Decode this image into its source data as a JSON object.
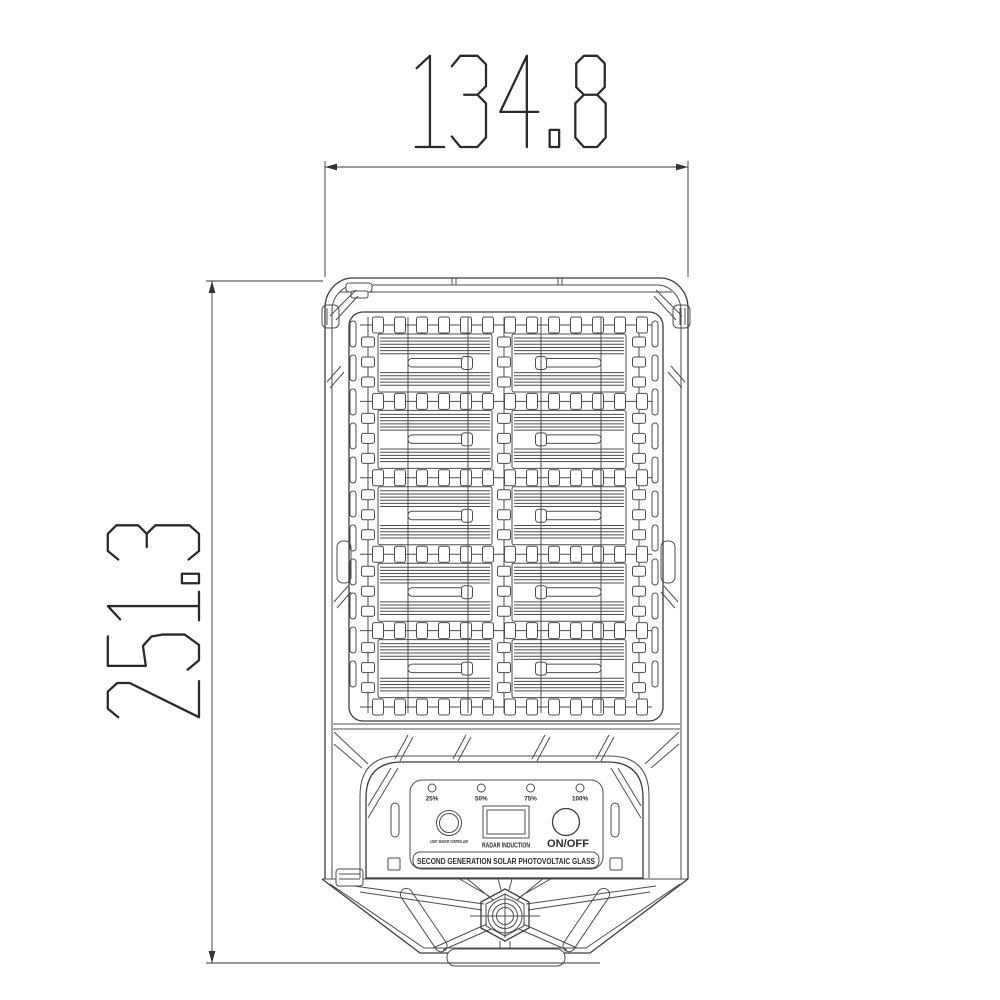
{
  "drawing": {
    "width_dim": "134.8",
    "height_dim": "251.3"
  },
  "control_panel": {
    "battery_levels": [
      "25%",
      "50%",
      "75%",
      "100%"
    ],
    "light_sensor_label": "LIGHT SENSOR CONTROLLER",
    "radar_label": "RADAR INDUCTION",
    "power_label": "ON/OFF",
    "banner": "SECOND GENERATION SOLAR PHOTOVOLTAIC GLASS"
  },
  "colors": {
    "background": "#ffffff",
    "line": "#4d4d4d",
    "dimension": "#2a2a2a"
  }
}
